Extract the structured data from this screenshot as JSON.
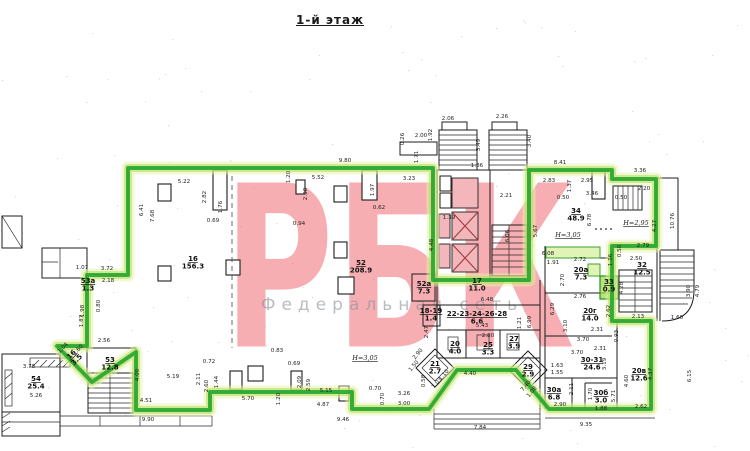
{
  "title": "1-й этаж",
  "watermark": {
    "brand": "РБК",
    "caption": "Федеральная сеть"
  },
  "colors": {
    "highlight_core": "#1ea32b",
    "highlight_glow": "#b5e161",
    "elevator_fill": "#f3b6ba",
    "watermark_pink": "#ee6b74",
    "wall": "#1c1c1c"
  },
  "floor_plan": {
    "rooms": [
      {
        "n": "16",
        "a": "156.3",
        "x": 193,
        "y": 243
      },
      {
        "n": "52",
        "a": "208.9",
        "x": 361,
        "y": 247
      },
      {
        "n": "52а",
        "a": "7.3",
        "x": 424,
        "y": 268
      },
      {
        "n": "17",
        "a": "11.0",
        "x": 477,
        "y": 265
      },
      {
        "n": "18-19",
        "a": "1.4",
        "x": 431,
        "y": 295
      },
      {
        "n": "22-23-24-26-28",
        "a": "6.6",
        "x": 477,
        "y": 298
      },
      {
        "n": "20",
        "a": "4.0",
        "x": 455,
        "y": 328
      },
      {
        "n": "25",
        "a": "3.3",
        "x": 488,
        "y": 329
      },
      {
        "n": "27",
        "a": "3.9",
        "x": 514,
        "y": 323
      },
      {
        "n": "21",
        "a": "2.7",
        "x": 435,
        "y": 348
      },
      {
        "n": "29",
        "a": "2.9",
        "x": 528,
        "y": 351
      },
      {
        "n": "34",
        "a": "48.9",
        "x": 576,
        "y": 195
      },
      {
        "n": "20а",
        "a": "7.3",
        "x": 581,
        "y": 254
      },
      {
        "n": "33",
        "a": "0.9",
        "x": 609,
        "y": 266
      },
      {
        "n": "32",
        "a": "12.5",
        "x": 642,
        "y": 249
      },
      {
        "n": "20г",
        "a": "14.0",
        "x": 590,
        "y": 295
      },
      {
        "n": "30-31",
        "a": "24.6",
        "x": 592,
        "y": 344
      },
      {
        "n": "20в",
        "a": "12.6",
        "x": 639,
        "y": 355
      },
      {
        "n": "30а",
        "a": "6.8",
        "x": 554,
        "y": 374
      },
      {
        "n": "30б",
        "a": "3.0",
        "x": 601,
        "y": 377
      },
      {
        "n": "53",
        "a": "12.8",
        "x": 110,
        "y": 344
      },
      {
        "n": "54",
        "a": "25.4",
        "x": 36,
        "y": 363
      },
      {
        "n": "16",
        "a": "3.5",
        "x": 73,
        "y": 338,
        "r": -45
      },
      {
        "n": "53а",
        "a": "1.3",
        "x": 88,
        "y": 265
      }
    ],
    "height_labels": [
      {
        "t": "Н=3,05",
        "x": 365,
        "y": 342
      },
      {
        "t": "Н=3,05",
        "x": 568,
        "y": 219
      },
      {
        "t": "Н=2,95",
        "x": 636,
        "y": 207
      }
    ],
    "dimensions": [
      [
        "9.80",
        345,
        144,
        0
      ],
      [
        "5.22",
        184,
        165,
        0
      ],
      [
        "5.52",
        318,
        161,
        0
      ],
      [
        "3.23",
        409,
        162,
        0
      ],
      [
        "1.20",
        290,
        159,
        -90
      ],
      [
        "2.98",
        307,
        176,
        -90
      ],
      [
        "1.97",
        374,
        172,
        -90
      ],
      [
        "0.62",
        379,
        191,
        0
      ],
      [
        "2.82",
        206,
        179,
        -90
      ],
      [
        "1.76",
        222,
        189,
        -90
      ],
      [
        "0.69",
        213,
        204,
        0
      ],
      [
        "6.41",
        143,
        192,
        -90
      ],
      [
        "7.68",
        154,
        198,
        -90
      ],
      [
        "0.94",
        299,
        207,
        0
      ],
      [
        "2.06",
        448,
        102,
        0
      ],
      [
        "2.26",
        502,
        100,
        0
      ],
      [
        "2.00",
        421,
        119,
        0
      ],
      [
        "1.92",
        432,
        117,
        -90
      ],
      [
        "0.26",
        404,
        121,
        -90
      ],
      [
        "1.71",
        418,
        139,
        -90
      ],
      [
        "3.49",
        480,
        127,
        -90
      ],
      [
        "3.40",
        531,
        123,
        -90
      ],
      [
        "1.86",
        477,
        149,
        0
      ],
      [
        "2.21",
        506,
        179,
        0
      ],
      [
        "1.39",
        449,
        201,
        0
      ],
      [
        "4.48",
        433,
        227,
        -90
      ],
      [
        "6.06",
        509,
        218,
        -90
      ],
      [
        "8.41",
        560,
        146,
        0
      ],
      [
        "2.83",
        549,
        164,
        0
      ],
      [
        "1.37",
        571,
        168,
        -90
      ],
      [
        "2.95",
        587,
        164,
        0
      ],
      [
        "0.50",
        563,
        181,
        0
      ],
      [
        "3.46",
        592,
        177,
        0
      ],
      [
        "3.36",
        640,
        154,
        0
      ],
      [
        "2.20",
        644,
        172,
        0
      ],
      [
        "0.50",
        621,
        181,
        0
      ],
      [
        "5.67",
        537,
        213,
        -90
      ],
      [
        "6.78",
        591,
        202,
        -90
      ],
      [
        "4.27",
        656,
        208,
        -90
      ],
      [
        "10.76",
        674,
        203,
        -90
      ],
      [
        "2.79",
        643,
        229,
        0
      ],
      [
        "0.50",
        621,
        233,
        -90
      ],
      [
        "6.08",
        548,
        237,
        0
      ],
      [
        "1.91",
        553,
        246,
        0
      ],
      [
        "2.72",
        580,
        243,
        0
      ],
      [
        "1.16",
        612,
        242,
        -90
      ],
      [
        "2.50",
        636,
        242,
        0
      ],
      [
        "2.70",
        564,
        262,
        -90
      ],
      [
        "4.28",
        623,
        270,
        -90
      ],
      [
        "2.76",
        580,
        280,
        0
      ],
      [
        "6.29",
        554,
        291,
        -90
      ],
      [
        "3.10",
        567,
        308,
        -90
      ],
      [
        "2.62",
        610,
        293,
        -90
      ],
      [
        "2.13",
        638,
        300,
        0
      ],
      [
        "2.31",
        597,
        313,
        0
      ],
      [
        "0.93",
        618,
        318,
        -90
      ],
      [
        "3.70",
        583,
        323,
        0
      ],
      [
        "2.31",
        600,
        332,
        0
      ],
      [
        "3.70",
        577,
        336,
        0
      ],
      [
        "3.19",
        606,
        346,
        -90
      ],
      [
        "1.63",
        557,
        349,
        0
      ],
      [
        "1.55",
        557,
        356,
        0
      ],
      [
        "2.11",
        573,
        371,
        -90
      ],
      [
        "1.70",
        592,
        376,
        -90
      ],
      [
        "5.71",
        615,
        378,
        -90
      ],
      [
        "4.60",
        628,
        363,
        -90
      ],
      [
        "4.37",
        652,
        356,
        -90
      ],
      [
        "2.90",
        560,
        388,
        0
      ],
      [
        "1.88",
        601,
        392,
        0
      ],
      [
        "2.62",
        641,
        390,
        0
      ],
      [
        "1.60",
        677,
        301,
        0
      ],
      [
        "3.90",
        690,
        273,
        -90
      ],
      [
        "4.79",
        699,
        273,
        -90
      ],
      [
        "6.15",
        691,
        358,
        -90
      ],
      [
        "9.35",
        586,
        408,
        0
      ],
      [
        "7.84",
        480,
        411,
        0
      ],
      [
        "9.46",
        343,
        403,
        0
      ],
      [
        "4.40",
        470,
        357,
        0
      ],
      [
        "7.40",
        527,
        369,
        -50
      ],
      [
        "1.08",
        533,
        375,
        -50
      ],
      [
        "1.03",
        438,
        366,
        -50
      ],
      [
        "1.10",
        445,
        358,
        -50
      ],
      [
        "0.58",
        425,
        363,
        -90
      ],
      [
        "2.90",
        419,
        337,
        -50
      ],
      [
        "1.50",
        415,
        349,
        -50
      ],
      [
        "3.26",
        404,
        377,
        0
      ],
      [
        "3.00",
        404,
        387,
        0
      ],
      [
        "0.70",
        375,
        372,
        0
      ],
      [
        "0.70",
        384,
        381,
        -90
      ],
      [
        "5.70",
        248,
        382,
        0
      ],
      [
        "1.20",
        280,
        381,
        -90
      ],
      [
        "0.69",
        294,
        347,
        0
      ],
      [
        "2.09",
        301,
        364,
        -90
      ],
      [
        "2.59",
        310,
        367,
        -90
      ],
      [
        "0.83",
        277,
        334,
        0
      ],
      [
        "5.15",
        326,
        374,
        0
      ],
      [
        "4.87",
        323,
        388,
        0
      ],
      [
        "5.19",
        173,
        360,
        0
      ],
      [
        "0.72",
        209,
        345,
        0
      ],
      [
        "2.11",
        200,
        361,
        -90
      ],
      [
        "2.60",
        208,
        368,
        -90
      ],
      [
        "1.44",
        218,
        364,
        -90
      ],
      [
        "4.51",
        146,
        384,
        0
      ],
      [
        "4.00",
        139,
        357,
        -90
      ],
      [
        "2.56",
        104,
        324,
        0
      ],
      [
        "3.78",
        29,
        350,
        0
      ],
      [
        "5.26",
        36,
        379,
        0
      ],
      [
        "1.04",
        64,
        331,
        -45
      ],
      [
        "1.60",
        79,
        333,
        -45
      ],
      [
        "1.07",
        82,
        251,
        0
      ],
      [
        "3.72",
        107,
        252,
        0
      ],
      [
        "2.18",
        108,
        264,
        0
      ],
      [
        "1.98",
        84,
        293,
        -90
      ],
      [
        "0.80",
        100,
        288,
        -90
      ],
      [
        "1.87",
        83,
        303,
        -90
      ],
      [
        "2.47",
        428,
        314,
        -90
      ],
      [
        "6.48",
        487,
        283,
        0
      ],
      [
        "5.43",
        482,
        309,
        0
      ],
      [
        "2.80",
        488,
        319,
        0
      ],
      [
        "1.21",
        521,
        305,
        -90
      ],
      [
        "6.99",
        531,
        304,
        -90
      ],
      [
        "9.90",
        148,
        403,
        0
      ]
    ]
  }
}
